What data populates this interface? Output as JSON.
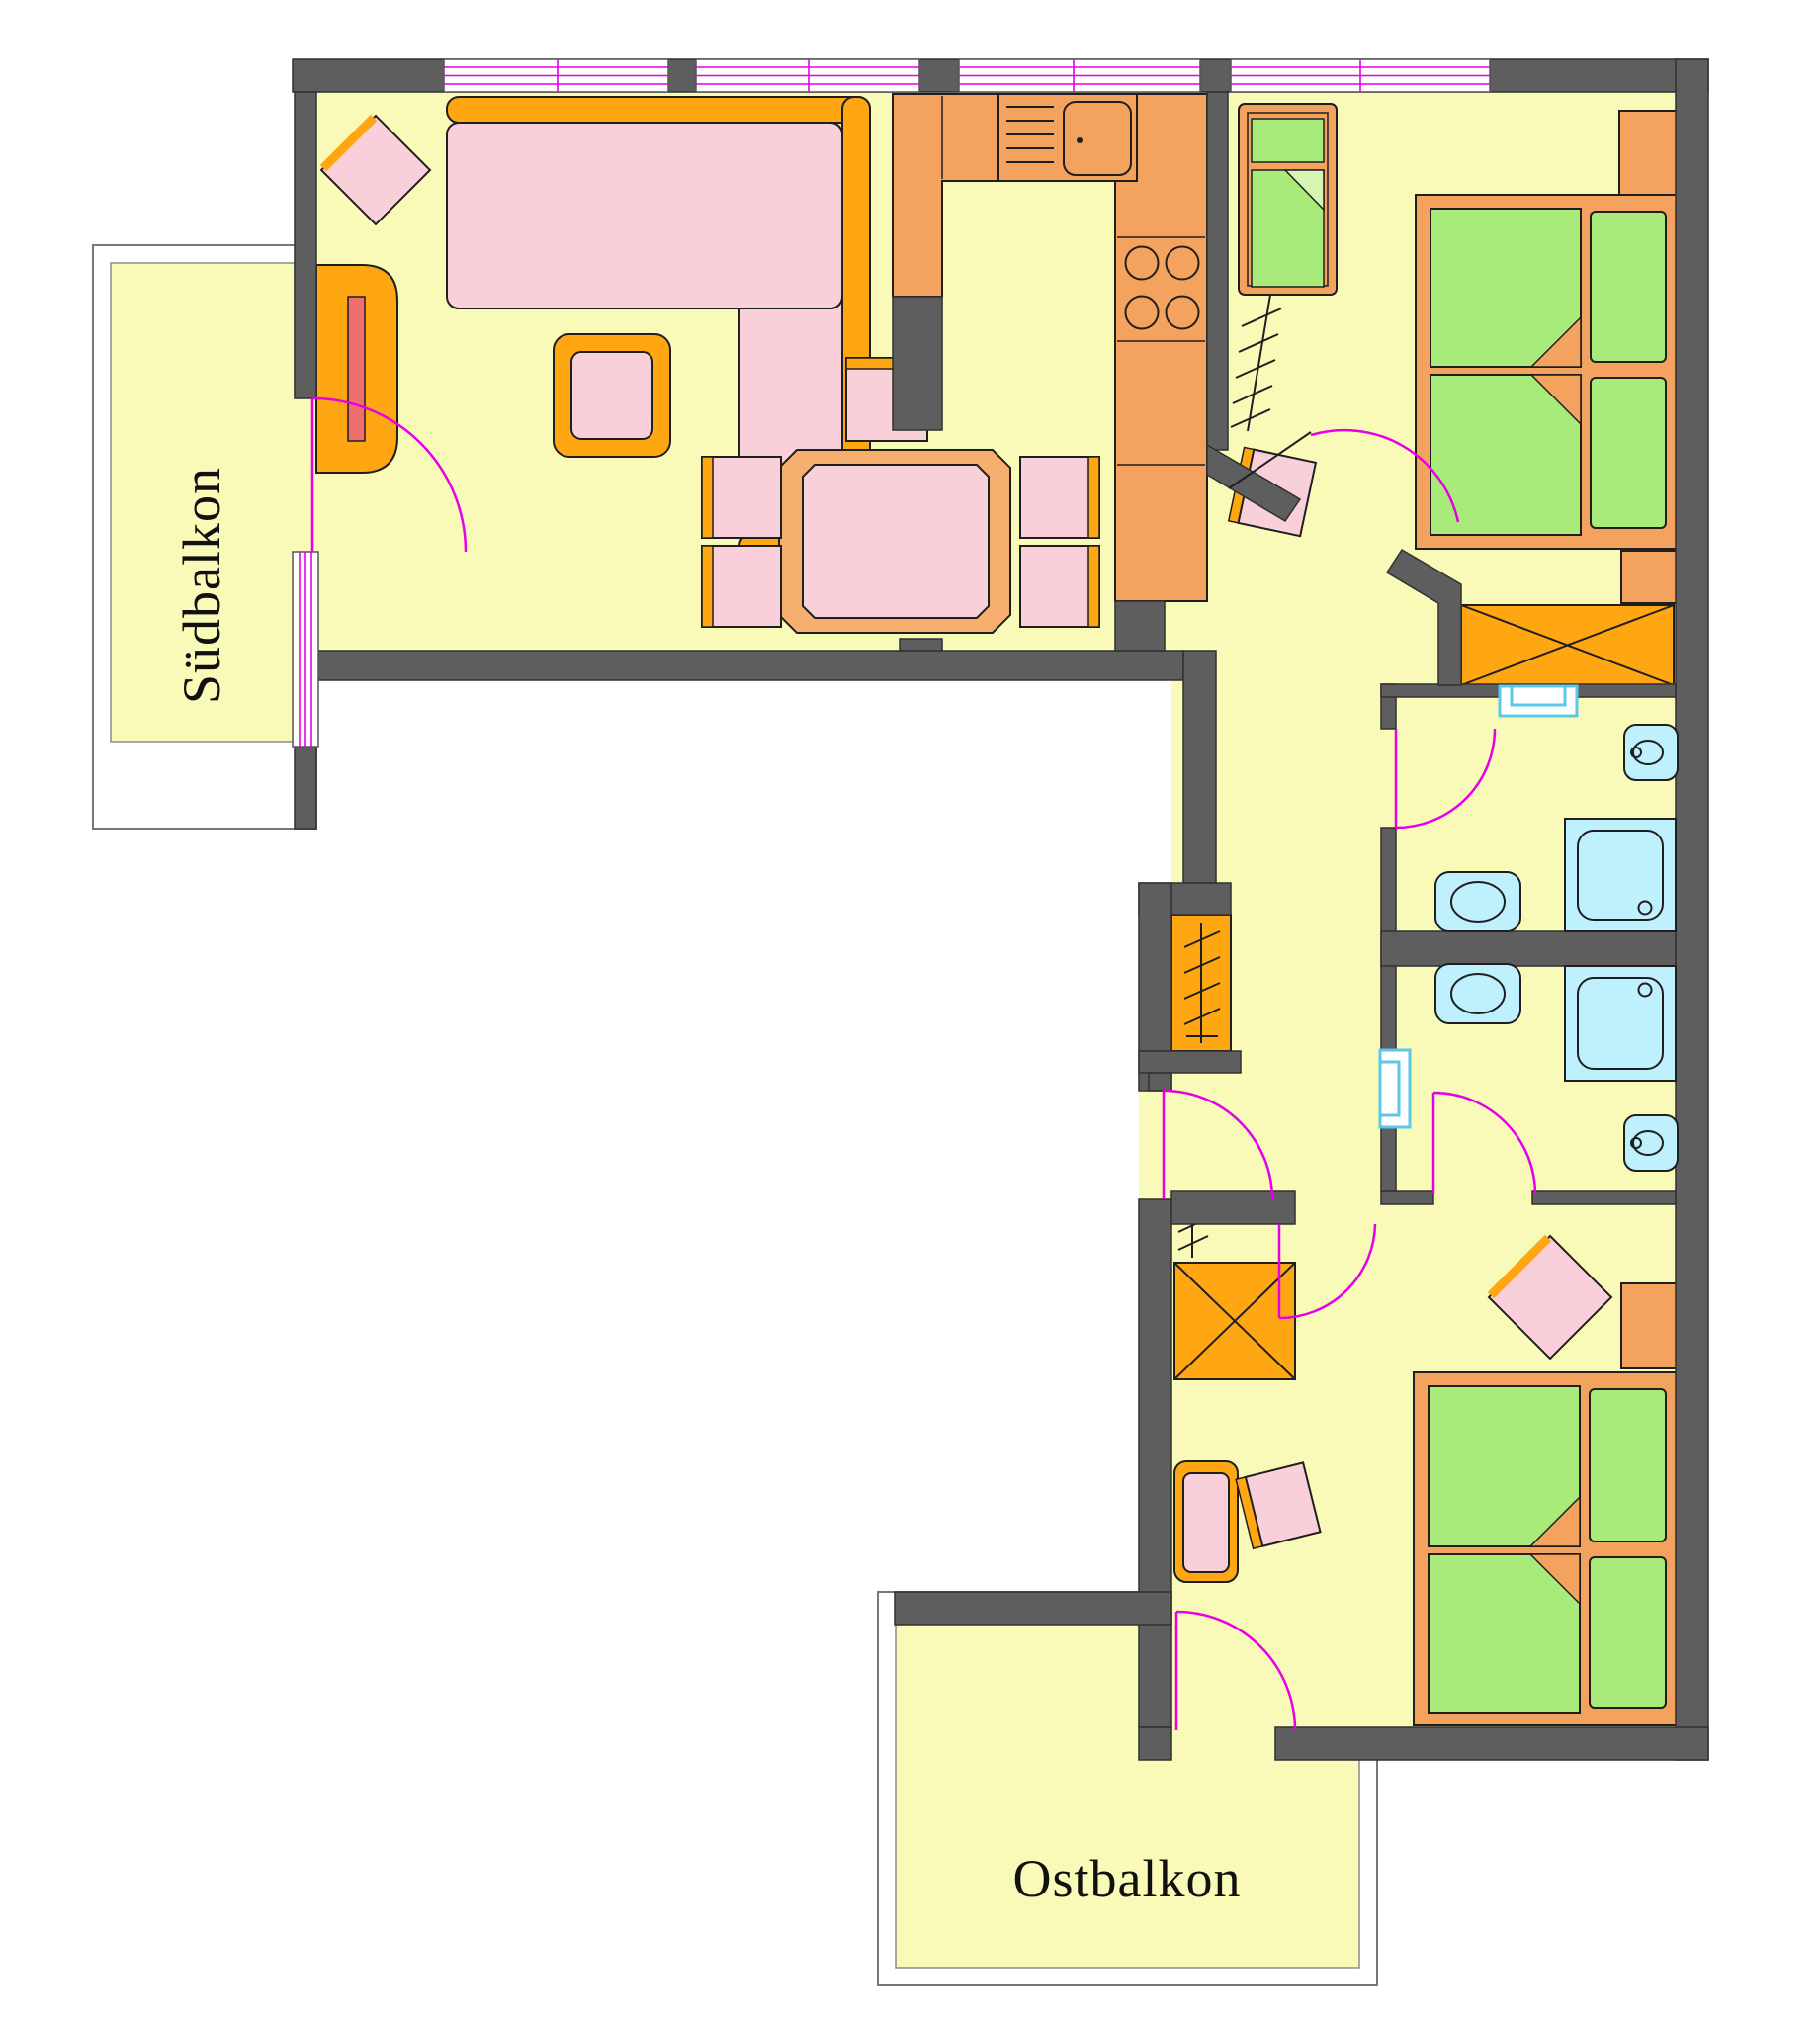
{
  "document": {
    "kind": "apartment floor plan drawing"
  },
  "labels": {
    "south_balcony": "Südbalkon",
    "east_balcony": "Ostbalkon"
  },
  "colors": {
    "wall": "#5E5E5E",
    "wall_outline": "#303030",
    "floor": "#FAFAB8",
    "furniture_orange": "#F4A35F",
    "accent_amber": "#FEA713",
    "table_peach": "#F5AE6E",
    "upholstery_pink": "#F9CFDA",
    "bed_green": "#A9EB7B",
    "fold_green": "#D6F5B0",
    "sanitary_blue": "#BFF0FD",
    "door_magenta": "#E700E7",
    "tv_red": "#EE6F6B",
    "balcony_outline": "#777777",
    "outline": "#1F1F1F"
  },
  "icons": [
    "corner-sofa",
    "side-table",
    "tv-cabinet",
    "cushion-diamond",
    "dining-table",
    "dining-chair",
    "kitchen-counter",
    "kitchen-sink",
    "stove-burners",
    "tall-cabinet",
    "child-bed",
    "double-bed",
    "nightstand",
    "built-in-wardrobe-x",
    "coat-rack-hatch",
    "shower-tray",
    "toilet",
    "washbasin",
    "interior-window",
    "door-swing-arc",
    "window-band"
  ]
}
